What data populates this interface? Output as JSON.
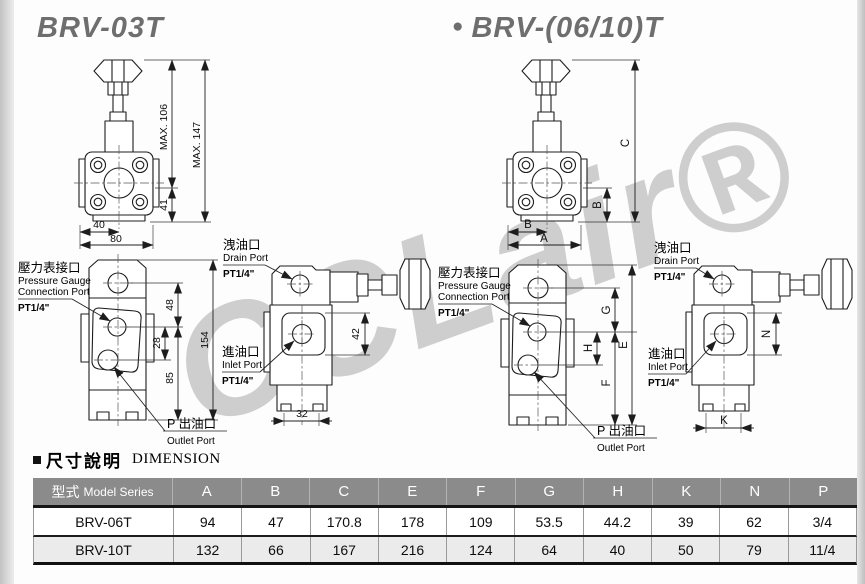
{
  "page": {
    "title_left": "BRV-03T",
    "title_right": "BRV-(06/10)T",
    "bullet": "●"
  },
  "watermark": {
    "text": "CCLair®"
  },
  "ports": {
    "pressure_gauge": {
      "zh": "壓力表接口",
      "en1": "Pressure Gauge",
      "en2": "Connection Port",
      "size": "PT1/4\""
    },
    "drain": {
      "zh": "洩油口",
      "en": "Drain Port",
      "size": "PT1/4\""
    },
    "inlet": {
      "zh": "進油口",
      "en": "Inlet Port",
      "size": "PT1/4\""
    },
    "outlet": {
      "zh": "P 出油口",
      "en": "Outlet Port"
    }
  },
  "dims_03t": {
    "max_upper": "MAX. 106",
    "max_total": "MAX. 147",
    "body_height": "41",
    "half_width": "40",
    "full_width": "80",
    "gauge_to_inlet": "48",
    "port_spacing": "28",
    "lower_height": "85",
    "total_height": "154",
    "inlet_height": "42",
    "foot_width": "32"
  },
  "dims_0610": {
    "c": "C",
    "b_side": "B",
    "b_bottom": "B",
    "a": "A",
    "g": "G",
    "h": "H",
    "f": "F",
    "e": "E",
    "n": "N",
    "k": "K"
  },
  "section": {
    "zh": "尺寸說明",
    "en": "DIMENSION"
  },
  "table": {
    "header_model": "型式",
    "header_model_en": "Model Series",
    "columns": [
      "A",
      "B",
      "C",
      "E",
      "F",
      "G",
      "H",
      "K",
      "N",
      "P"
    ],
    "rows": [
      {
        "model": "BRV-06T",
        "values": [
          "94",
          "47",
          "170.8",
          "178",
          "109",
          "53.5",
          "44.2",
          "39",
          "62",
          "3/4"
        ]
      },
      {
        "model": "BRV-10T",
        "values": [
          "132",
          "66",
          "167",
          "216",
          "124",
          "64",
          "40",
          "50",
          "79",
          "11/4"
        ]
      }
    ]
  }
}
